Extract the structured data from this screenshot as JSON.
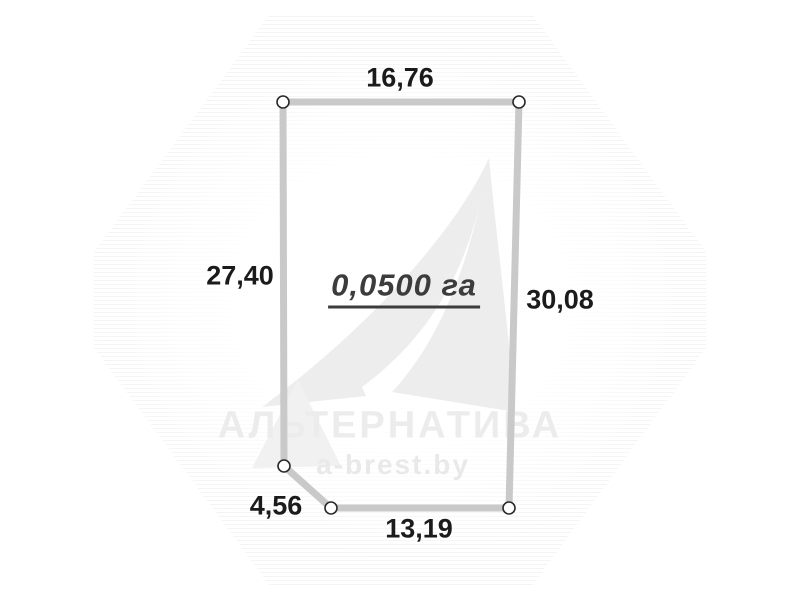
{
  "page": {
    "background_color": "#ffffff"
  },
  "watermark": {
    "company": "АЛЬТЕРНАТИВА",
    "site": "a-brest.by",
    "company_pos": {
      "x": 390,
      "y": 426
    },
    "site_pos": {
      "x": 393,
      "y": 465
    },
    "text_color": "#ececec",
    "logo": "sail-logo",
    "logo_color": "#ededed"
  },
  "plot": {
    "area_label": "0,0500 га",
    "area_label_pos": {
      "x": 404,
      "y": 288
    },
    "outline_color": "#c9c9c9",
    "outline_width": 7,
    "label_color": "#1b1b1b",
    "vertex_marker": {
      "fill": "#ffffff",
      "stroke": "#2a2a2a",
      "radius": 6
    },
    "vertices": [
      {
        "x": 283,
        "y": 102
      },
      {
        "x": 519,
        "y": 102
      },
      {
        "x": 509,
        "y": 508
      },
      {
        "x": 331,
        "y": 508
      },
      {
        "x": 284,
        "y": 466
      }
    ],
    "edges": [
      {
        "side": "top",
        "label": "16,76",
        "x": 400,
        "y": 78
      },
      {
        "side": "right",
        "label": "30,08",
        "x": 560,
        "y": 300
      },
      {
        "side": "bottom",
        "label": "13,19",
        "x": 419,
        "y": 529
      },
      {
        "side": "bottom-left-diagonal",
        "label": "4,56",
        "x": 276,
        "y": 506
      },
      {
        "side": "left",
        "label": "27,40",
        "x": 240,
        "y": 276
      }
    ]
  }
}
